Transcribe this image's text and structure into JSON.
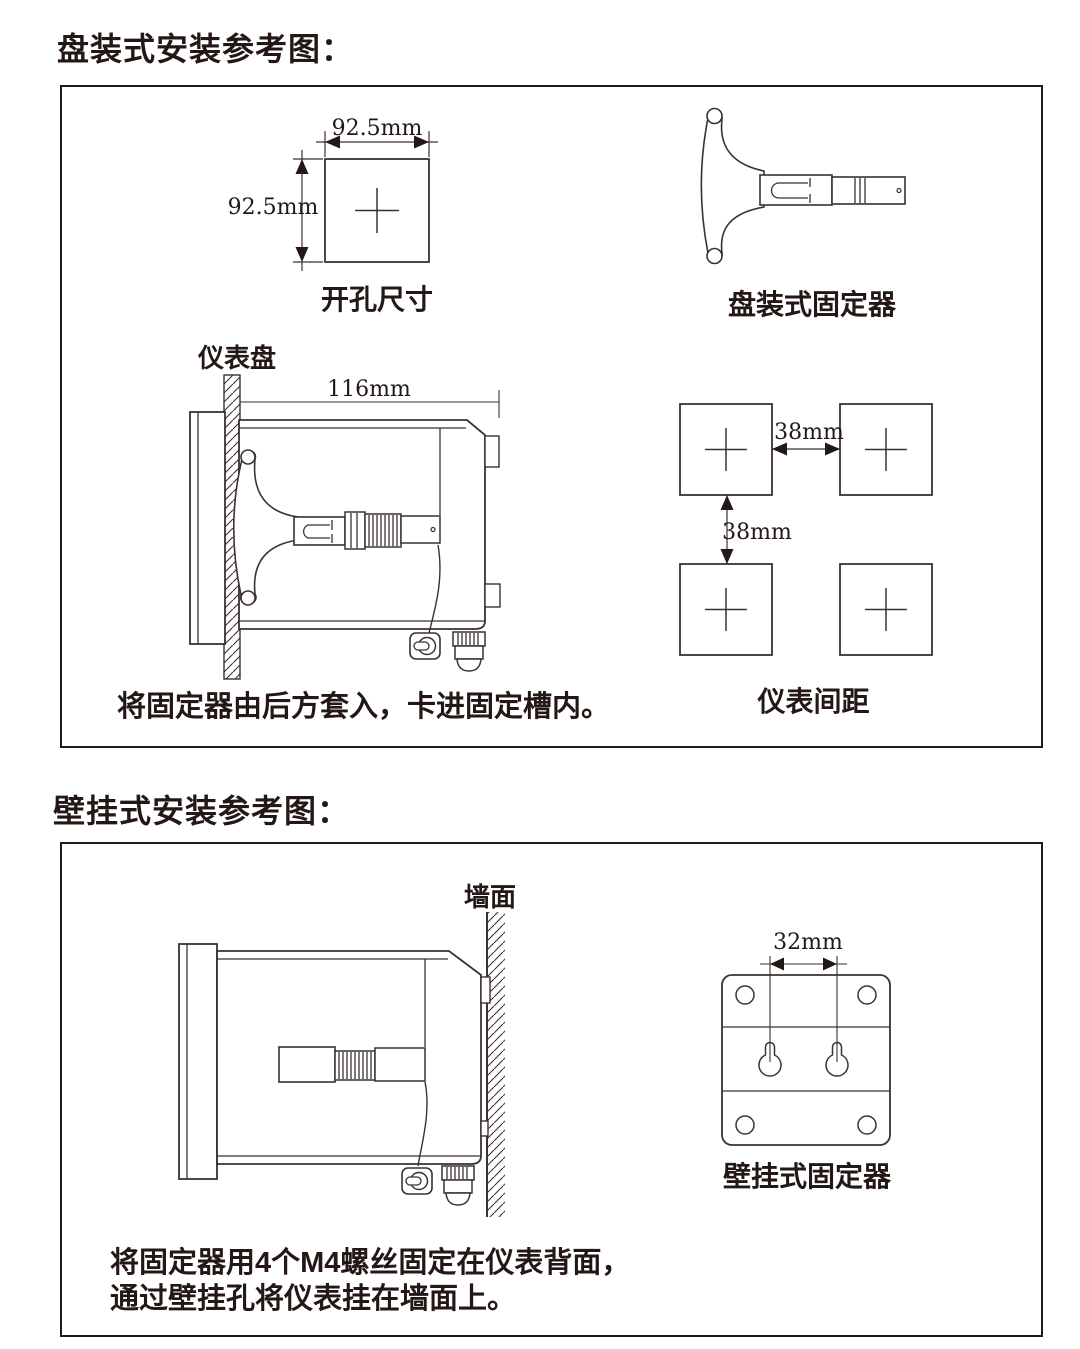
{
  "titles": {
    "panel": "盘装式安装参考图：",
    "wall": "壁挂式安装参考图："
  },
  "panel_box": {
    "cutout": {
      "width_dim": "92.5mm",
      "height_dim": "92.5mm",
      "label": "开孔尺寸"
    },
    "fixer": {
      "label": "盘装式固定器"
    },
    "side_view": {
      "panel_label": "仪表盘",
      "depth_dim": "116mm"
    },
    "spacing": {
      "h_dim": "38mm",
      "v_dim": "38mm",
      "label": "仪表间距"
    },
    "caption": "将固定器由后方套入，卡进固定槽内。"
  },
  "wall_box": {
    "side_view": {
      "wall_label": "墙面"
    },
    "fixer": {
      "hole_dim": "32mm",
      "label": "壁挂式固定器"
    },
    "caption_line1": "将固定器用4个M4螺丝固定在仪表背面，",
    "caption_line2": "通过壁挂孔将仪表挂在墙面上。"
  },
  "colors": {
    "ink": "#231815",
    "stroke": "#3a322f"
  }
}
